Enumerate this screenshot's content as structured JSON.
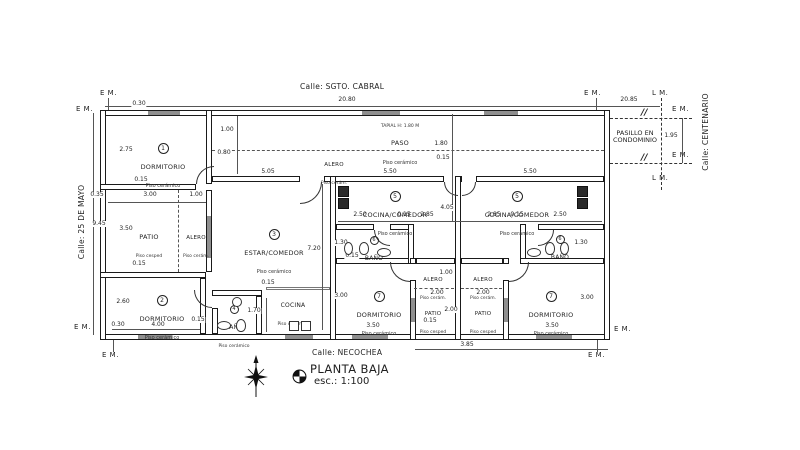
{
  "title": {
    "name": "PLANTA BAJA",
    "scale": "esc.: 1:100"
  },
  "streets": {
    "top": "Calle: SGTO. CABRAL",
    "bottom": "Calle: NECOCHEA",
    "left": "Calle: 25 DE MAYO",
    "right": "Calle: CENTENARIO"
  },
  "corridor": {
    "line1": "PASILLO EN",
    "line2": "CONDOMINIO"
  },
  "markers": {
    "em": "E M.",
    "lm": "L M.",
    "hatch": "//"
  },
  "areas": {
    "paso": {
      "name": "PASO",
      "floor": "Piso cerámico",
      "note": "TAPIAL H: 1.80 M"
    },
    "alero": {
      "name": "ALERO",
      "floor": "Piso cerám."
    },
    "patio": {
      "name": "PATIO",
      "floor": "Piso cesped"
    },
    "cocina": {
      "name": "COCINA",
      "floor": "Piso cerámico"
    }
  },
  "rooms": {
    "r1": {
      "num": "1",
      "name": "DORMITORIO",
      "floor": "Piso cerámico"
    },
    "r2": {
      "num": "2",
      "name": "DORMITORIO",
      "floor": "Piso cerámico"
    },
    "r3": {
      "num": "3",
      "name": "ESTAR/COMEDOR",
      "floor": "Piso cerámico"
    },
    "r4": {
      "num": "4",
      "name": "BAÑO",
      "floor": "Piso cerámico"
    },
    "r5": {
      "num": "5",
      "name": "COCINA/COMEDOR",
      "floor": "Piso cerámico"
    },
    "r6": {
      "num": "6",
      "name": "BAÑO",
      "floor": "Piso cerámico"
    },
    "r7": {
      "num": "7",
      "name": "DORMITORIO",
      "floor": "Piso cerámico"
    }
  },
  "dims": {
    "d2080": "20.80",
    "d2085": "20.85",
    "d195": "1.95",
    "d030": "0.30",
    "d275": "2.75",
    "d015": "0.15",
    "d100": "1.00",
    "d080": "0.80",
    "d505": "5.05",
    "d180": "1.80",
    "d550": "5.50",
    "d035": "0.35",
    "d300": "3.00",
    "d945": "9.45",
    "d350": "3.50",
    "d260": "2.60",
    "d400": "4.00",
    "d720": "7.20",
    "d130": "1.30",
    "d170": "1.70",
    "d250": "2.50",
    "d285": "2.85",
    "d405": "4.05",
    "d200": "2.00",
    "d385": "3.85"
  },
  "colors": {
    "line": "#1f1f1f",
    "window": "#8f8f8f",
    "paper": "#ffffff"
  }
}
